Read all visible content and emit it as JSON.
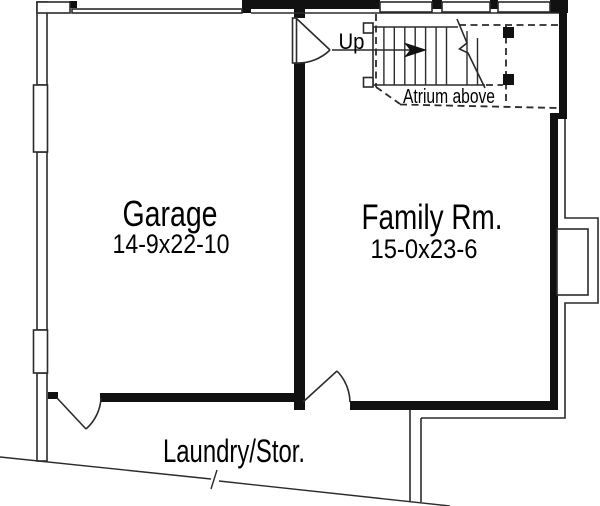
{
  "rooms": {
    "garage": {
      "label": "Garage",
      "dimensions": "14-9x22-10"
    },
    "family_room": {
      "label": "Family Rm.",
      "dimensions": "15-0x23-6"
    },
    "laundry_storage": {
      "label": "Laundry/Stor."
    }
  },
  "stairs": {
    "label": "Up"
  },
  "notes": {
    "atrium": "Atrium above"
  },
  "colors": {
    "wall": "#111111",
    "line": "#2b2b2b",
    "text": "#000000",
    "background": "#ffffff"
  }
}
